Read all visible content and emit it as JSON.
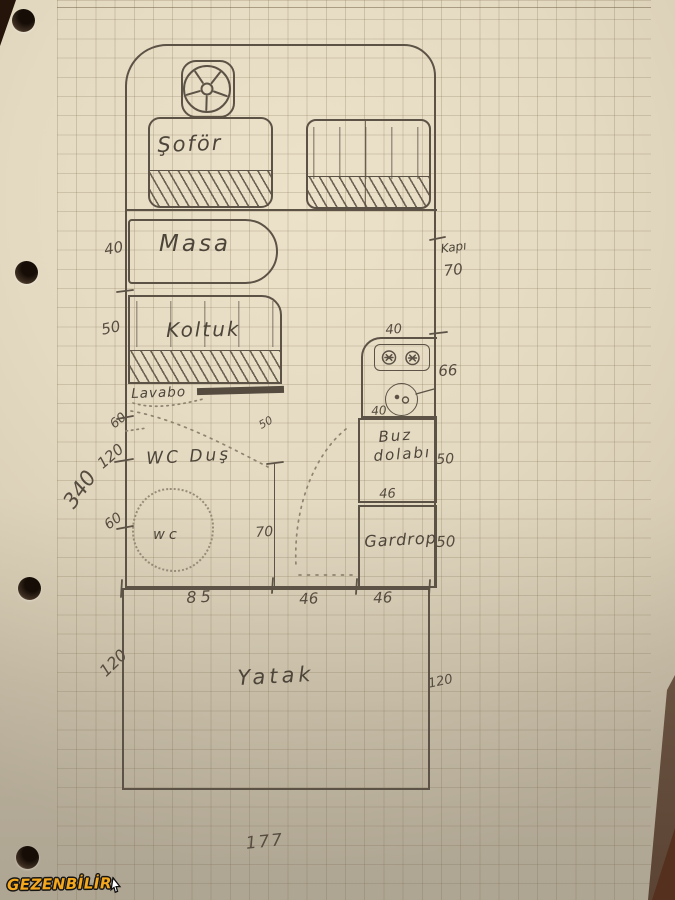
{
  "watermark": {
    "brand": "GEZENBİLİR"
  },
  "floorplan": {
    "cab": {
      "driver_seat": "Şoför"
    },
    "dinette": {
      "table": "Masa",
      "table_depth": "40",
      "sofa": "Koltuk",
      "sofa_depth": "50"
    },
    "bathroom": {
      "sink": "Lavabo",
      "room": "WC Duş",
      "toilet": "wc",
      "seg_upper": "60",
      "seg_mid": "120",
      "seg_lower": "60",
      "shower_note": "50",
      "inner_length": "70",
      "width": "85"
    },
    "entry": {
      "door": "Kapı",
      "door_width": "70",
      "corridor_width": "46"
    },
    "kitchen": {
      "stove_width": "40",
      "counter_length": "66",
      "sink_width": "40",
      "fridge_line1": "Buz",
      "fridge_line2": "dolabı",
      "fridge_depth": "50",
      "unit_width": "46"
    },
    "wardrobe": {
      "label": "Gardrop",
      "depth": "50",
      "width": "46"
    },
    "bed": {
      "label": "Yatak",
      "depth_left": "120",
      "depth_right": "120"
    },
    "totals": {
      "left_height": "340",
      "overall_width": "177"
    }
  }
}
